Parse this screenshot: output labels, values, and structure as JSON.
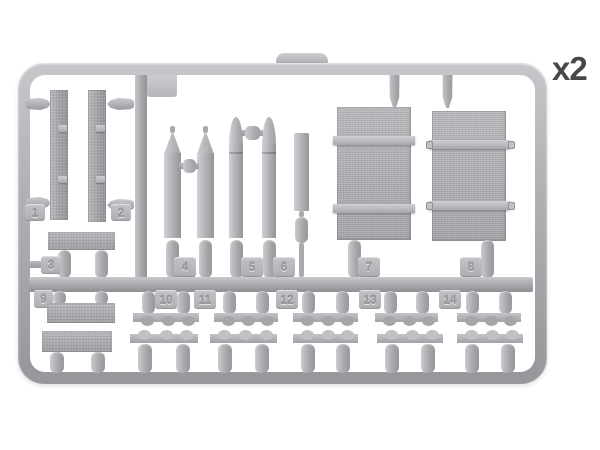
{
  "photo": {
    "subject_name": "model-kit-plastic-sprue",
    "quantity_label": "x2",
    "part_numbers": [
      "1",
      "2",
      "3",
      "4",
      "5",
      "6",
      "7",
      "8",
      "9",
      "10",
      "11",
      "12",
      "13",
      "14"
    ],
    "colors": {
      "plastic_light": "#cbccd0",
      "plastic_mid": "#b2b3b7",
      "plastic_dark": "#94959a",
      "background": "#ffffff",
      "quantity_text": "#47484b"
    }
  }
}
